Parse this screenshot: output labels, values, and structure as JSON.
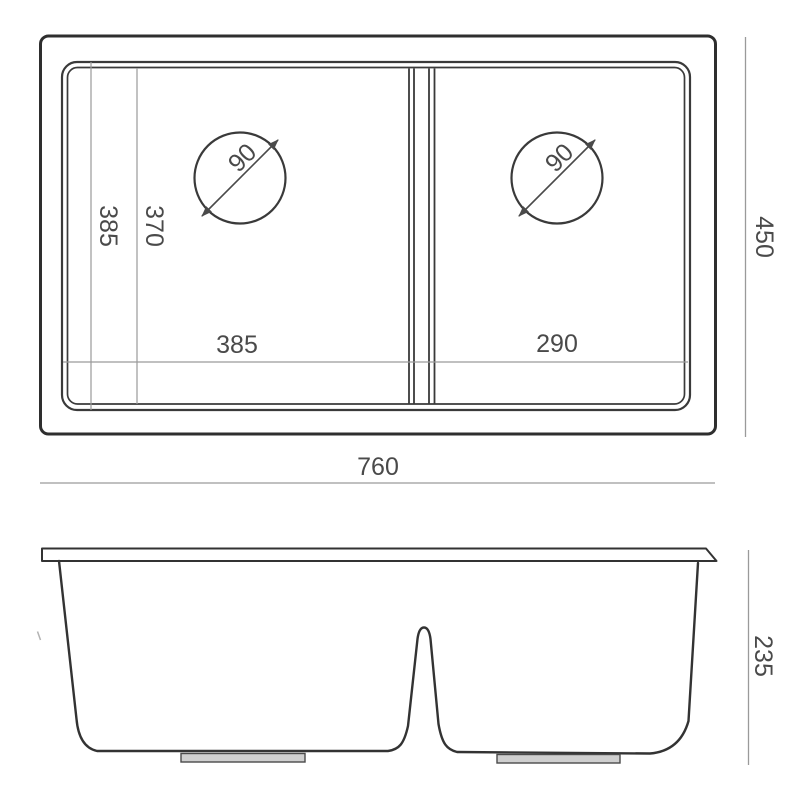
{
  "top_view": {
    "overall_width": "760",
    "overall_depth": "450",
    "left_bowl_width": "385",
    "right_bowl_width": "290",
    "bowl_outer_depth": "385",
    "bowl_inner_depth": "370",
    "left_drain_diameter": "90",
    "right_drain_diameter": "90"
  },
  "front_view": {
    "overall_height": "235"
  },
  "colors": {
    "background": "#ffffff",
    "outline": "#2e2e2e",
    "dimension_line": "#9a9a9a",
    "text": "#4a4a4a"
  }
}
